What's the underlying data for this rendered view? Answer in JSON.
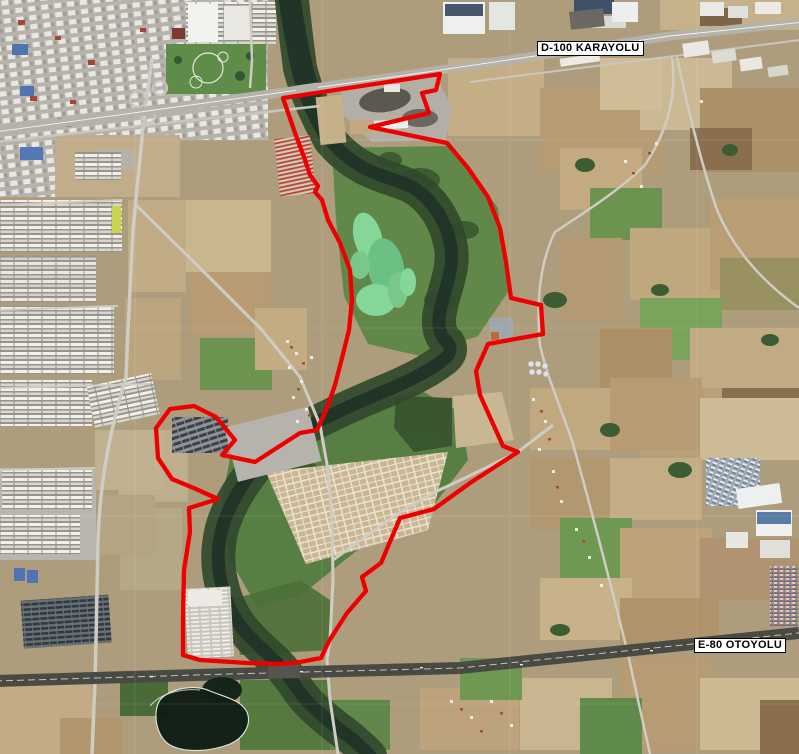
{
  "labels": {
    "d100": "D-100 KARAYOLU",
    "e80": "E-80 OTOYOLU"
  },
  "colors": {
    "boundary": "#ee0000",
    "river": "#203528",
    "riparian": "#31492c",
    "pond": "#101e16",
    "label_bg": "#ffffff",
    "label_text": "#000000"
  },
  "boundary": {
    "points": "283,98 440,74 436,90 422,93 429,113 370,127 447,143 468,168 488,197 500,228 506,262 511,298 541,305 543,334 488,344 476,371 480,395 503,446 518,452 470,483 434,509 400,518 381,563 362,577 366,591 347,613 329,641 321,658 300,662 280,664 247,663 200,660 183,655 183,618 184,570 190,532 189,508 218,499 196,489 172,479 158,458 156,428 170,409 194,406 216,417 235,440 222,455 255,462 300,433 317,430 327,408 335,385 342,358 349,330 352,300 350,270 340,243 328,220 322,200 315,192 318,186 310,175 304,157 295,133"
  },
  "river": {
    "path": "M 291,-8 C 294,20 297,45 300,68 C 306,92 315,112 330,140 C 340,152 355,165 375,173 C 392,180 403,182 412,187 C 428,196 440,212 447,231 C 452,247 453,258 450,272 C 446,290 441,302 439,317 C 438,330 442,338 448,343 C 452,349 450,355 443,360 C 428,372 405,383 378,394 C 352,405 325,417 302,430 C 283,441 268,452 252,472 C 238,490 228,508 222,528 C 218,545 217,558 220,577 C 224,597 230,612 242,628 C 254,643 266,652 277,663 C 286,672 291,679 297,688 C 306,702 318,712 330,722 C 344,733 355,740 370,756",
    "upper_path": "M 289,-6 C 293,25 298,50 303,72 C 309,95 318,115 332,138"
  },
  "pond": {
    "path": "M 160,700 C 170,688 195,684 210,691 C 225,697 241,700 247,712 C 252,724 244,738 230,744 C 210,752 185,753 170,745 C 156,737 152,712 160,700 Z"
  }
}
